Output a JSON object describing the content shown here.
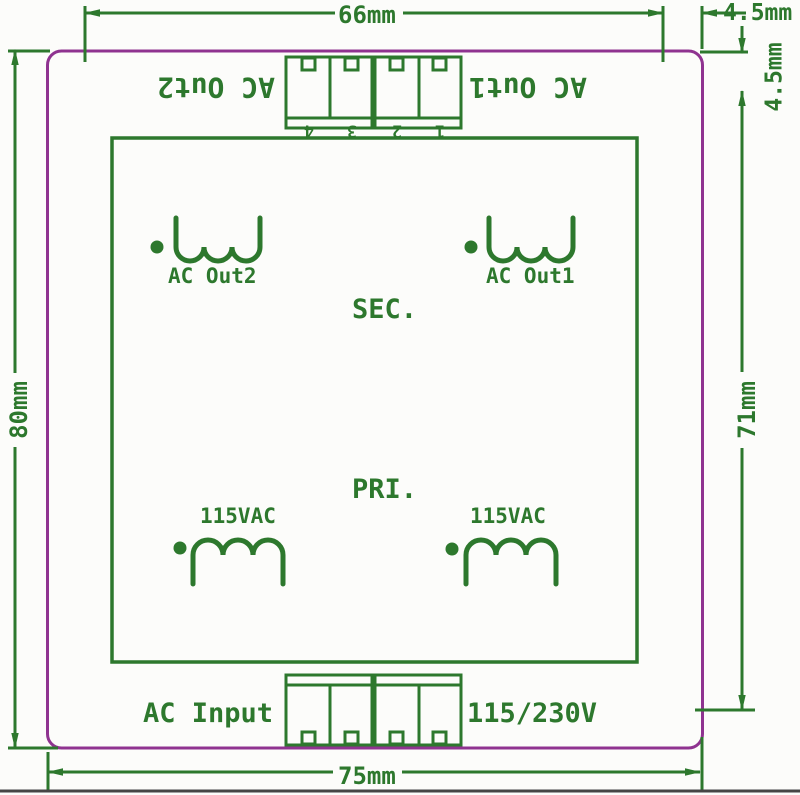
{
  "diagram": {
    "title_hint": "PCB transformer module dimension drawing",
    "dimensions": {
      "top_width": "66mm",
      "top_right_offset": "4.5mm",
      "right_top_offset": "4.5mm",
      "left_height": "80mm",
      "right_height": "71mm",
      "bottom_width": "75mm"
    },
    "top_connector": {
      "label_out2": "AC Out2",
      "label_out1": "AC Out1",
      "pins": [
        "4",
        "3",
        "2",
        "1"
      ]
    },
    "transformer": {
      "secondary_label": "SEC.",
      "primary_label": "PRI.",
      "coil_out2_label": "AC Out2",
      "coil_out1_label": "AC Out1",
      "primary_left_voltage": "115VAC",
      "primary_right_voltage": "115VAC"
    },
    "bottom_connector": {
      "input_label": "AC Input",
      "voltage_label": "115/230V"
    },
    "colors": {
      "board_outline": "#8f3390",
      "silkscreen_green": "#2d782d",
      "background": "#fcfcfa",
      "photo_edge": "#454545"
    }
  }
}
